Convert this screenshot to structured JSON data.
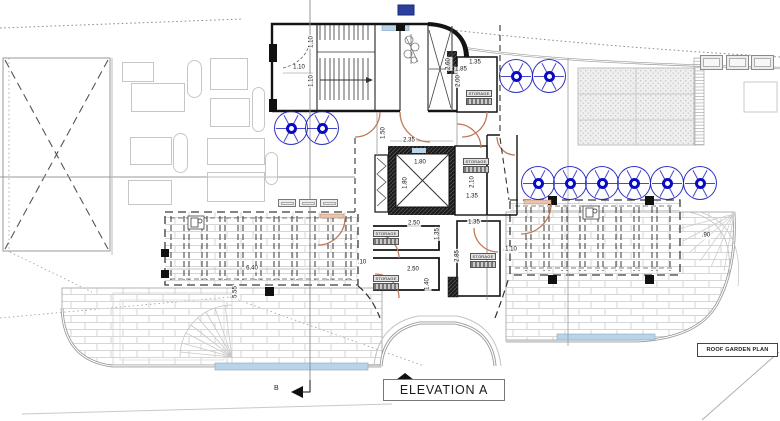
{
  "labels": {
    "elevation_a": "ELEVATION A",
    "roof_garden_plan": "ROOF GARDEN PLAN",
    "section_b": "B",
    "storage": "STORAGE"
  },
  "colors": {
    "tree_blue": "#0a0ac2",
    "door_orange": "#c07a58",
    "glass_blue": "#b9d3e8",
    "wall_black": "#141414",
    "water_blue": "#b9d3e8",
    "marker_blue": "#2b3f9e"
  },
  "dimensions": [
    [
      299,
      68,
      0,
      "1.10"
    ],
    [
      312,
      42,
      -90,
      "1.10"
    ],
    [
      312,
      81,
      -90,
      "1.10"
    ],
    [
      449,
      64,
      -90,
      "2.60"
    ],
    [
      461,
      70,
      0,
      "1.85"
    ],
    [
      459,
      81,
      -90,
      "2.00"
    ],
    [
      475,
      63,
      0,
      "1.35"
    ],
    [
      384,
      133,
      -90,
      "1.50"
    ],
    [
      409,
      141,
      0,
      "2.35"
    ],
    [
      420,
      163,
      0,
      "1.80"
    ],
    [
      406,
      183,
      -90,
      "1.80"
    ],
    [
      473,
      182,
      -90,
      "2.10"
    ],
    [
      472,
      197,
      0,
      "1.35"
    ],
    [
      414,
      224,
      0,
      "2.50"
    ],
    [
      474,
      223,
      0,
      "1.35"
    ],
    [
      438,
      234,
      -90,
      "1.35"
    ],
    [
      458,
      256,
      -90,
      "2.85"
    ],
    [
      413,
      270,
      0,
      "2.50"
    ],
    [
      428,
      284,
      -90,
      "1.40"
    ],
    [
      511,
      250,
      0,
      "1.10"
    ],
    [
      252,
      269,
      0,
      "6.40"
    ],
    [
      236,
      292,
      -90,
      "5.55"
    ],
    [
      362,
      263,
      0,
      ".10"
    ],
    [
      706,
      236,
      0,
      ".90"
    ]
  ],
  "symbols": {
    "trees": [
      [
        291,
        128
      ],
      [
        322,
        128
      ],
      [
        516,
        76
      ],
      [
        549,
        76
      ],
      [
        538,
        183
      ],
      [
        570,
        183
      ],
      [
        602,
        183
      ],
      [
        634,
        183
      ],
      [
        667,
        183
      ],
      [
        700,
        183
      ]
    ],
    "loungers": [
      [
        122,
        62,
        32,
        20
      ],
      [
        131,
        83,
        54,
        29
      ],
      [
        210,
        58,
        38,
        32
      ],
      [
        210,
        98,
        40,
        29
      ],
      [
        130,
        137,
        42,
        28
      ],
      [
        207,
        138,
        58,
        27
      ],
      [
        128,
        180,
        44,
        25
      ],
      [
        207,
        172,
        58,
        30
      ]
    ],
    "side_tables": [
      [
        187,
        60,
        15,
        38
      ],
      [
        252,
        87,
        13,
        45
      ],
      [
        173,
        133,
        15,
        40
      ],
      [
        265,
        152,
        13,
        33
      ]
    ],
    "ac_units_large": [
      [
        700,
        55
      ],
      [
        726,
        55
      ],
      [
        751,
        55
      ]
    ],
    "ac_units_small": [
      [
        278,
        199
      ],
      [
        299,
        199
      ],
      [
        320,
        199
      ]
    ],
    "storage_labels": [
      [
        466,
        90
      ],
      [
        463,
        158
      ],
      [
        373,
        230
      ],
      [
        373,
        275
      ],
      [
        470,
        253
      ]
    ]
  }
}
